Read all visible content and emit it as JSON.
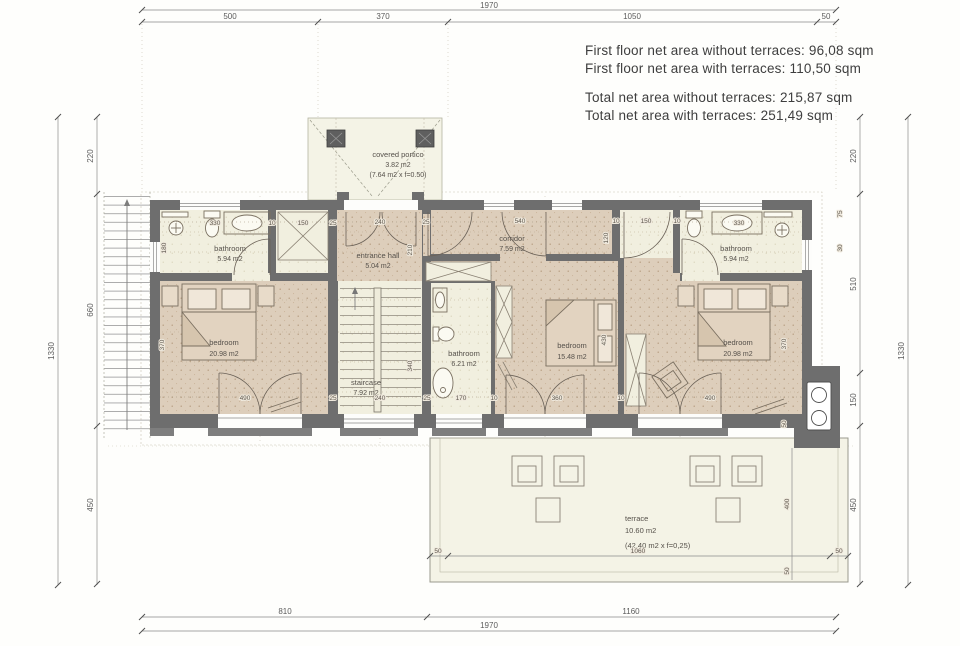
{
  "summary": {
    "first_without": "First floor net area without terraces: 96,08 sqm",
    "first_with": "First floor net area with terraces: 110,50 sqm",
    "total_without": "Total net area without terraces: 215,87 sqm",
    "total_with": "Total net area with terraces: 251,49 sqm"
  },
  "rooms": {
    "bathroom_left": {
      "name": "bathroom",
      "area": "5.94 m2"
    },
    "entrance_hall": {
      "name": "entrance hall",
      "area": "5.04 m2"
    },
    "corridor": {
      "name": "corridor",
      "area": "7.59 m2"
    },
    "bathroom_right": {
      "name": "bathroom",
      "area": "5.94 m2"
    },
    "bedroom_left": {
      "name": "bedroom",
      "area": "20.98 m2"
    },
    "staircase": {
      "name": "staircase",
      "area": "7.92 m2"
    },
    "bathroom_middle": {
      "name": "bathroom",
      "area": "6.21 m2"
    },
    "bedroom_middle": {
      "name": "bedroom",
      "area": "15.48 m2"
    },
    "bedroom_right": {
      "name": "bedroom",
      "area": "20.98 m2"
    },
    "covered_portico": {
      "name": "covered portico",
      "area": "3.82 m2",
      "note": "(7.64 m2 x f=0.50)"
    },
    "terrace": {
      "name": "terrace",
      "area": "10.60 m2",
      "note": "(42.40 m2 x f=0,25)"
    }
  },
  "dims": {
    "top_overall": "1970",
    "top_segments": [
      "500",
      "370",
      "1050",
      "50"
    ],
    "bottom_segments": [
      "810",
      "1160"
    ],
    "bottom_overall": "1970",
    "left_segments": [
      "220",
      "660",
      "450"
    ],
    "left_overall": "1330",
    "right_segments": [
      "220",
      "510",
      "150",
      "450"
    ],
    "right_overall": "1330",
    "interior_top": [
      "330",
      "10",
      "150",
      "25",
      "240",
      "25",
      "540",
      "10",
      "150",
      "10",
      "330"
    ],
    "interior_bottom": [
      "490",
      "25",
      "240",
      "25",
      "170",
      "10",
      "360",
      "10",
      "490"
    ],
    "vertical_labels": [
      "180",
      "210",
      "120",
      "340",
      "370",
      "430",
      "370",
      "75",
      "30",
      "50",
      "400",
      "50"
    ],
    "terrace_row": [
      "50",
      "1060",
      "50"
    ]
  },
  "colors": {
    "wall": "#6e6e6e",
    "floor_tan": "#ddcebb",
    "floor_ivory": "#f1efdf",
    "terrace_fill": "#f4f3e6",
    "dim_text": "#5c5c5c"
  }
}
